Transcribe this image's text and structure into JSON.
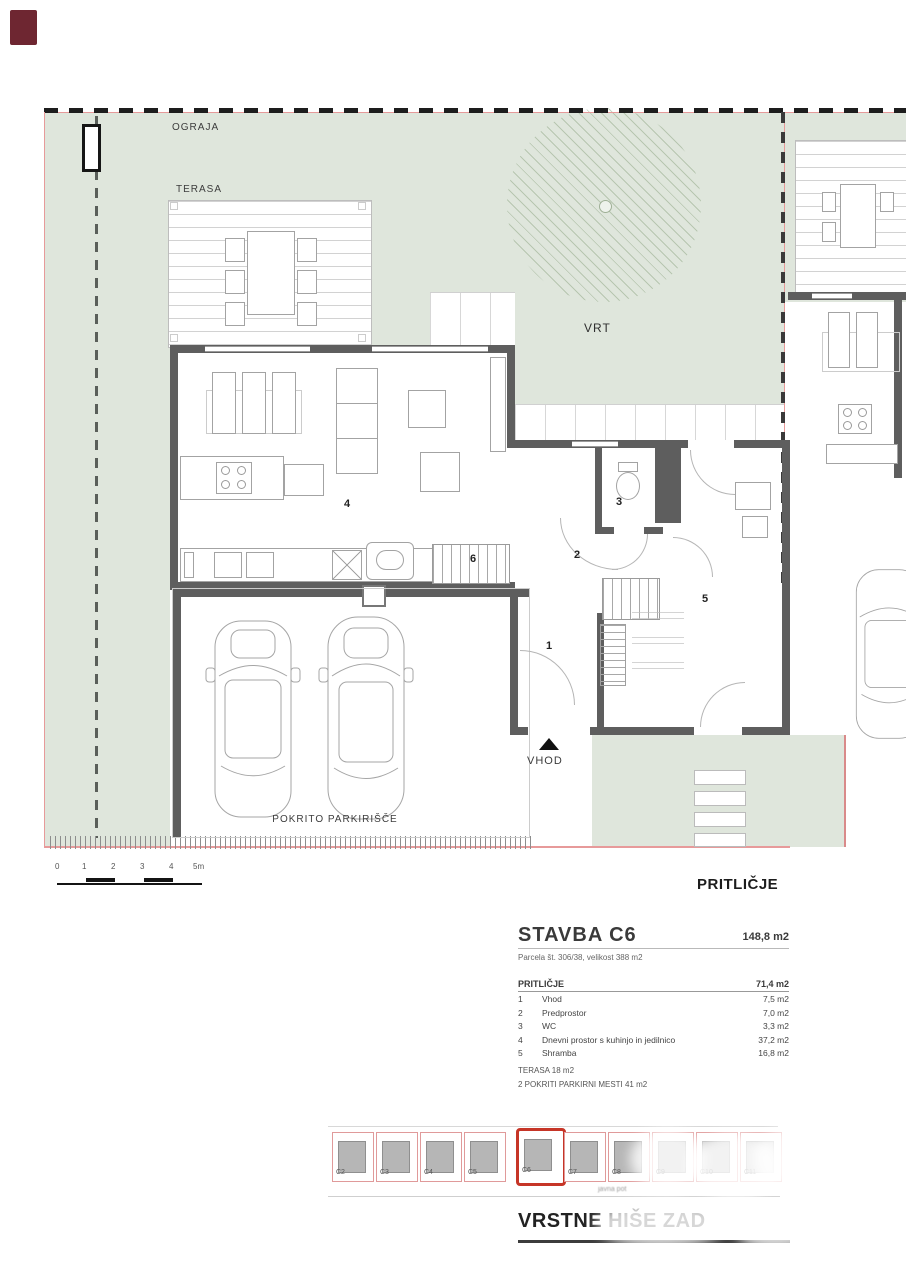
{
  "colors": {
    "garden": "#dfe6dc",
    "wall": "#5e5e5e",
    "parcel_line": "#e79a9a",
    "highlight_red": "#c63527",
    "corner_swatch": "#6e2631"
  },
  "plan": {
    "labels": {
      "ograja": "OGRAJA",
      "terasa": "TERASA",
      "vrt": "VRT",
      "vhod": "VHOD",
      "pokrito_parkirisce": "POKRITO PARKIRIŠČE"
    },
    "room_numbers": [
      {
        "n": "1",
        "x": 546,
        "y": 640
      },
      {
        "n": "2",
        "x": 574,
        "y": 549
      },
      {
        "n": "3",
        "x": 616,
        "y": 496
      },
      {
        "n": "4",
        "x": 344,
        "y": 498
      },
      {
        "n": "5",
        "x": 702,
        "y": 593
      },
      {
        "n": "6",
        "x": 470,
        "y": 553
      }
    ]
  },
  "scalebar": {
    "ticks": [
      "0",
      "1",
      "2",
      "3",
      "4",
      "5m"
    ]
  },
  "floor_label": "PRITLIČJE",
  "summary": {
    "building_title": "STAVBA C6",
    "building_area": "148,8 m2",
    "parcel_line": "Parcela št. 306/38, velikost 388 m2",
    "floor_header": "PRITLIČJE",
    "floor_area": "71,4 m2",
    "rooms": [
      {
        "no": "1",
        "name": "Vhod",
        "area": "7,5 m2"
      },
      {
        "no": "2",
        "name": "Predprostor",
        "area": "7,0 m2"
      },
      {
        "no": "3",
        "name": "WC",
        "area": "3,3 m2"
      },
      {
        "no": "4",
        "name": "Dnevni prostor s kuhinjo in jedilnico",
        "area": "37,2 m2"
      },
      {
        "no": "5",
        "name": "Shramba",
        "area": "16,8 m2"
      }
    ],
    "terrace_line": "TERASA  18 m2",
    "parking_line": "2 POKRITI PARKIRNI MESTI 41 m2"
  },
  "site_map": {
    "units": [
      "C2",
      "C3",
      "C4",
      "C5",
      "C6",
      "C7",
      "C8",
      "C9",
      "C10",
      "C11"
    ],
    "highlighted_unit": "C6",
    "caption": "javna pot"
  },
  "project_title": "VRSTNE HIŠE ZAD"
}
